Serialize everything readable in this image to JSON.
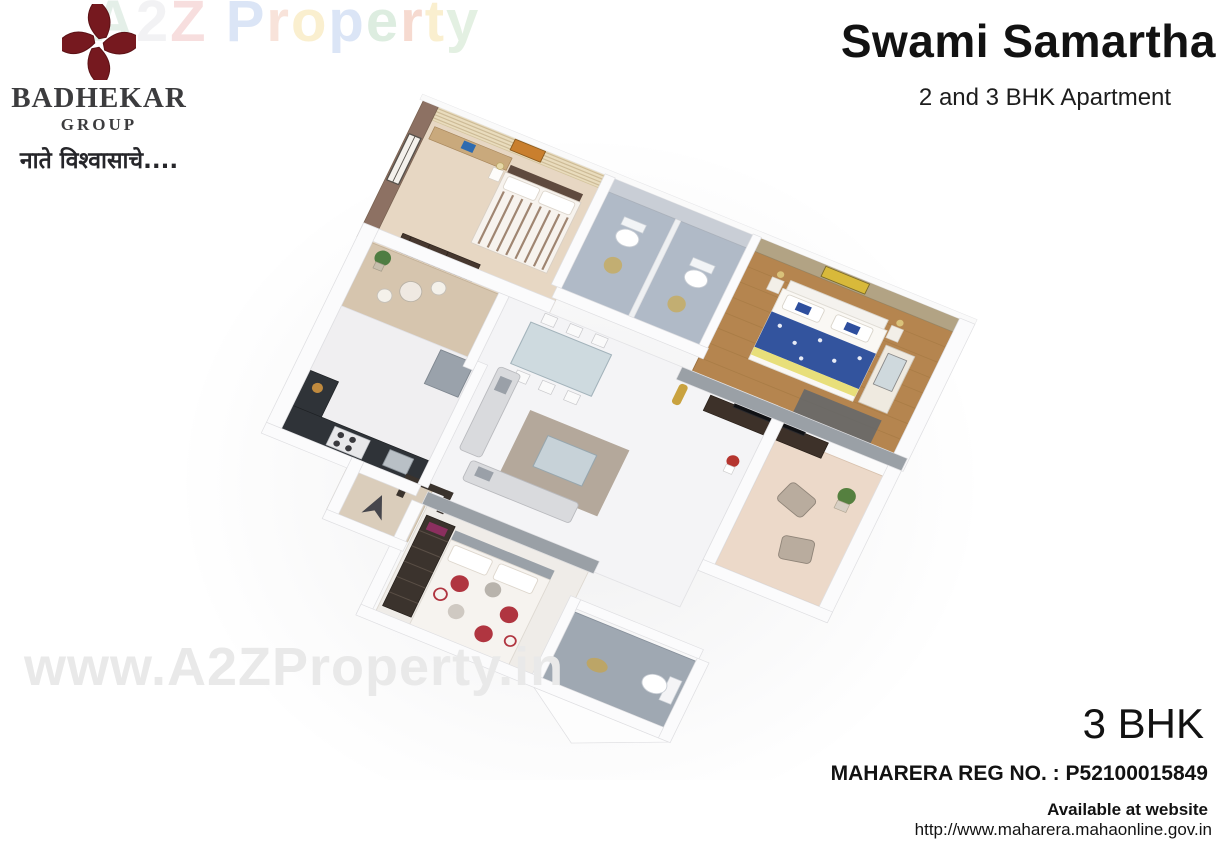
{
  "brand": {
    "name": "BADHEKAR",
    "sub": "GROUP",
    "tagline": "नाते विश्वासाचे....",
    "logo_color": "#76191f"
  },
  "header": {
    "title": "Swami Samartha",
    "subtitle": "2 and 3 BHK Apartment"
  },
  "watermark_top": {
    "text": "A2Z Property",
    "letters": [
      {
        "ch": "A",
        "color": "#cfe3d6"
      },
      {
        "ch": "2",
        "color": "#e9e9ec"
      },
      {
        "ch": "Z",
        "color": "#f2c4c4"
      },
      {
        "ch": " ",
        "color": "#ffffff"
      },
      {
        "ch": "P",
        "color": "#bfd0ef"
      },
      {
        "ch": "r",
        "color": "#f4cdbd"
      },
      {
        "ch": "o",
        "color": "#f6e2a8"
      },
      {
        "ch": "p",
        "color": "#bfd0ef"
      },
      {
        "ch": "e",
        "color": "#c3dfc8"
      },
      {
        "ch": "r",
        "color": "#f0bcab"
      },
      {
        "ch": "t",
        "color": "#f6e2a8"
      },
      {
        "ch": "y",
        "color": "#cde4cb"
      }
    ]
  },
  "watermark_bottom": {
    "text": "www.A2ZProperty.in",
    "color": "#e9e9e9"
  },
  "footer": {
    "unit_type": "3 BHK",
    "rera": "MAHARERA REG NO. : P52100015849",
    "availability": "Available at website",
    "website": "http://www.maharera.mahaonline.gov.in"
  },
  "palette": {
    "brand_maroon": "#76191f",
    "bedroom1_floor": "#e7d7c3",
    "bedroom1_wall": "#8d7163",
    "stripe_wall": "#e9dcbd",
    "bath_floor": "#b0bac7",
    "master_floor": "#b5854f",
    "master_wall": "#b2a384",
    "sitout_floor": "#d6c5ae",
    "living_floor": "#f4f4f6",
    "balcony_floor": "#ecd9c9",
    "bedroom2_floor": "#efece8",
    "bath3_floor": "#9fa8b2",
    "counter_dark": "#2f3338",
    "duvet_blue": "#33549e",
    "polka_red": "#b03540",
    "gray_wall": "#9aa0a6",
    "wall_white": "#fbfbfc"
  }
}
